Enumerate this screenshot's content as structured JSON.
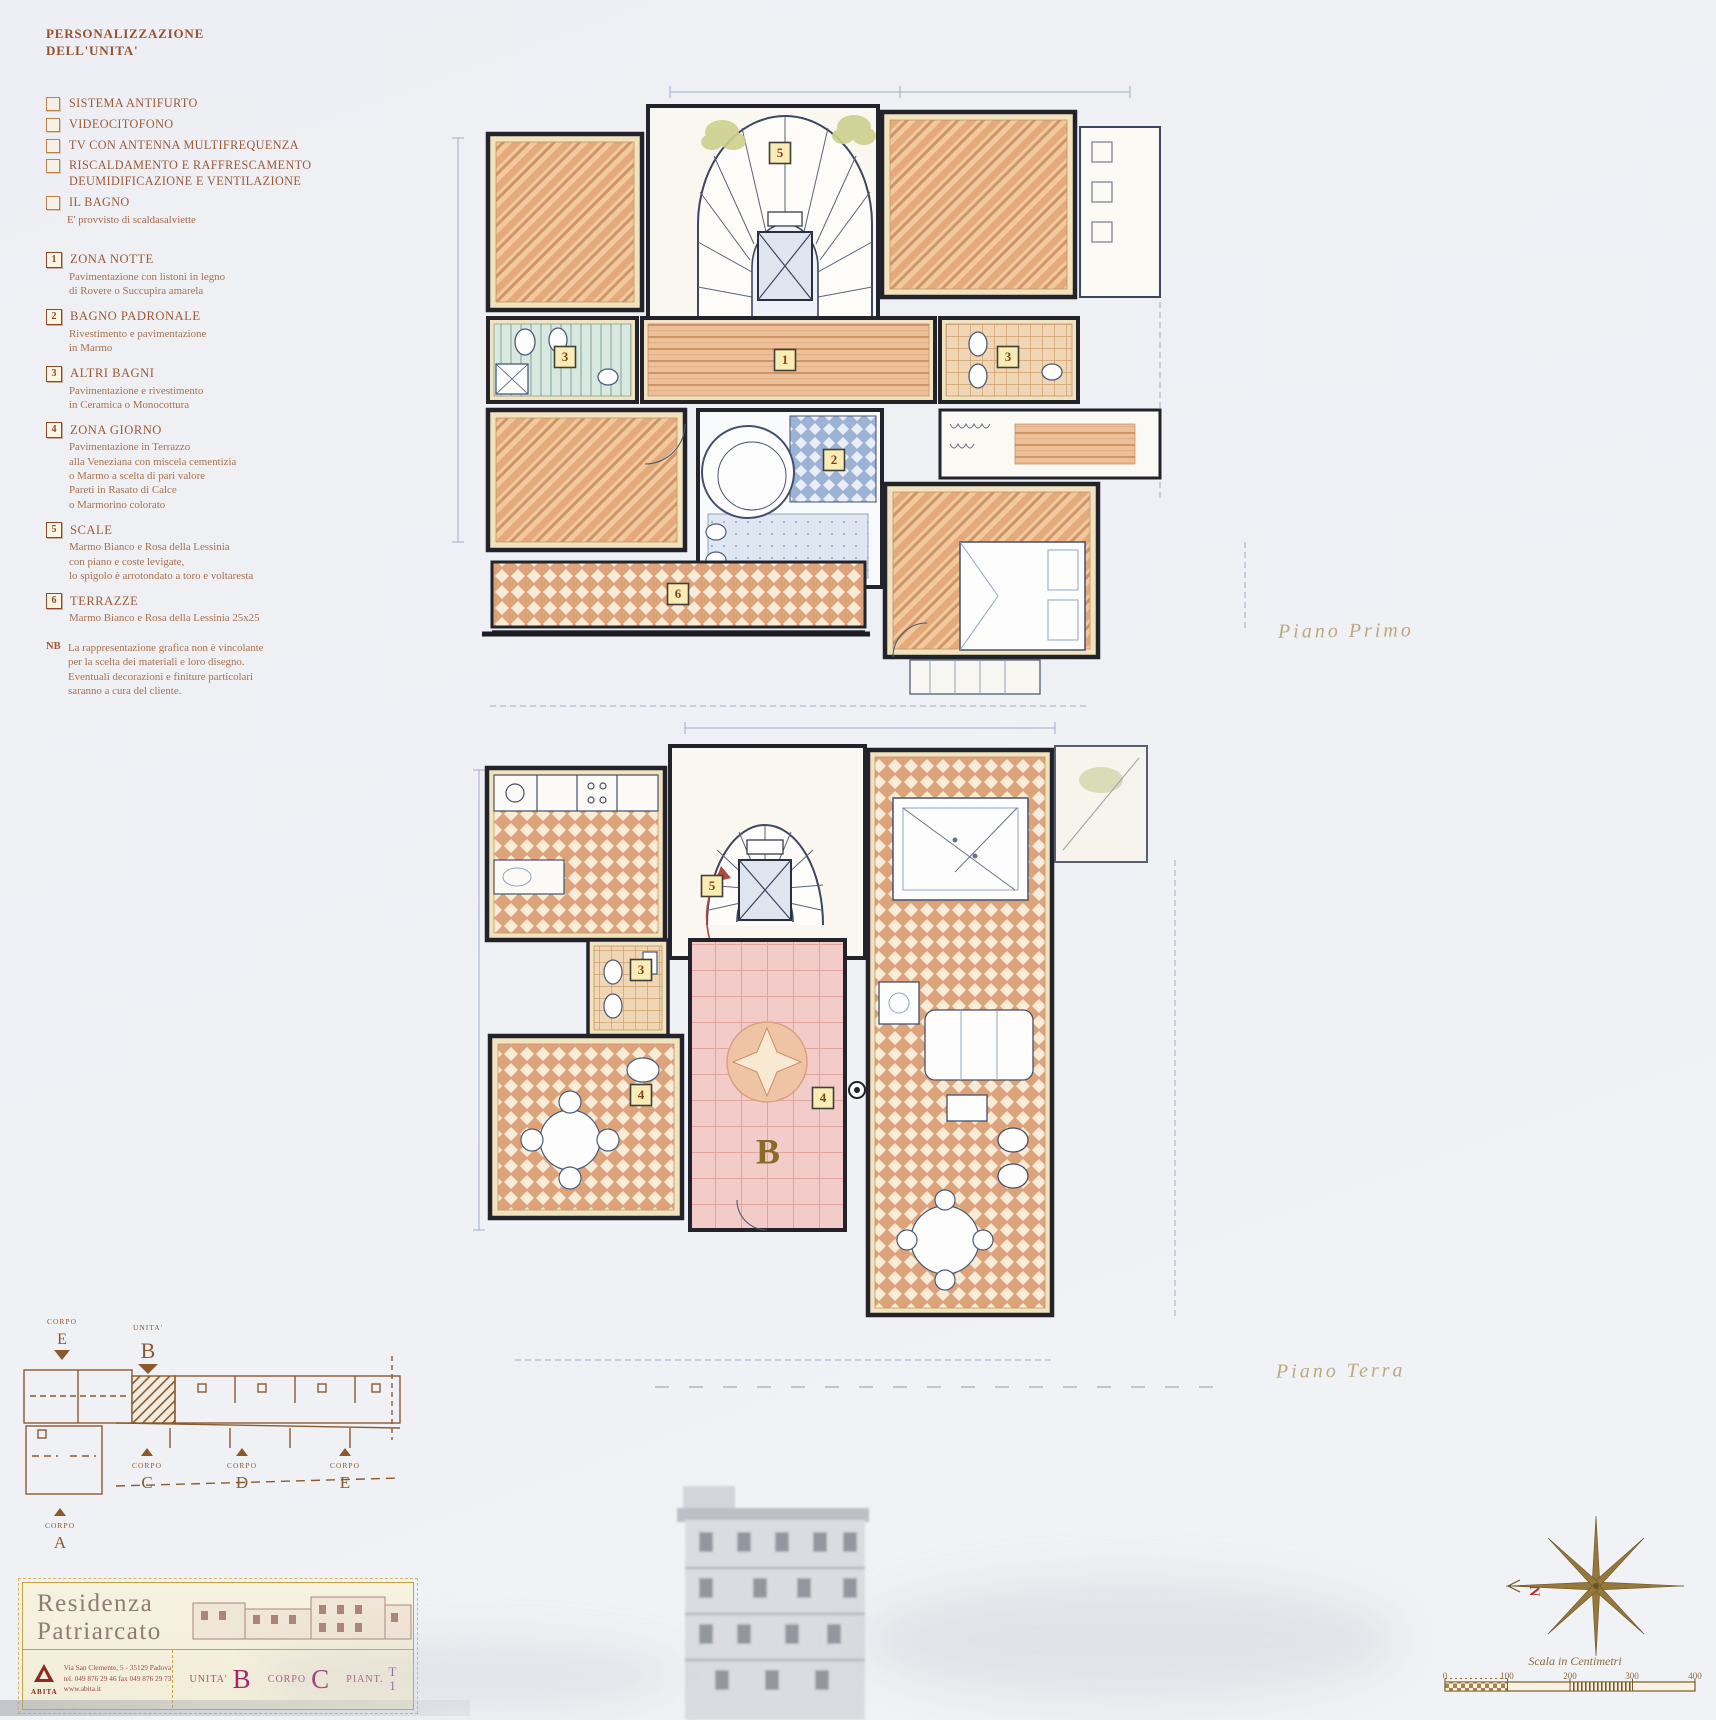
{
  "colors": {
    "paper": "#eff1f5",
    "ink": "#23232c",
    "sepia": "#9c5a36",
    "wood": "#edbd92",
    "tile_terracotta": "#dda47c",
    "terrazzo_pink": "#f3cbc8",
    "bath_blue": "#9db3d6",
    "bath_teal": "#d9e8e1",
    "badge_bg": "#f9ecb4",
    "gold": "#c9a23f",
    "magenta": "#a3266b",
    "site_ink": "#8a5a2e",
    "north_red": "#b23530"
  },
  "legend": {
    "title": "PERSONALIZZAZIONE\nDELL'UNITA'",
    "options": [
      {
        "text": "SISTEMA ANTIFURTO"
      },
      {
        "text": "VIDEOCITOFONO"
      },
      {
        "text": "TV CON ANTENNA MULTIFREQUENZA"
      },
      {
        "text": "RISCALDAMENTO E RAFFRESCAMENTO\nDEUMIDIFICAZIONE E VENTILAZIONE"
      },
      {
        "text": "IL BAGNO",
        "note": "E' provvisto di scaldasalviette"
      }
    ],
    "materials": [
      {
        "num": "1",
        "title": "ZONA NOTTE",
        "desc": "Pavimentazione con listoni in legno\ndi Rovere o Succupira amarela"
      },
      {
        "num": "2",
        "title": "BAGNO PADRONALE",
        "desc": "Rivestimento e pavimentazione\nin Marmo"
      },
      {
        "num": "3",
        "title": "ALTRI BAGNI",
        "desc": "Pavimentazione e rivestimento\nin Ceramica o Monocottura"
      },
      {
        "num": "4",
        "title": "ZONA GIORNO",
        "desc": "Pavimentazione in Terrazzo\nalla Veneziana con miscela cementizia\no Marmo a scelta di pari valore\nPareti in Rasato di Calce\no Marmorino colorato"
      },
      {
        "num": "5",
        "title": "SCALE",
        "desc": "Marmo Bianco e Rosa della Lessinia\ncon piano e coste levigate,\nlo spigolo è arrotondato a toro e voltaresta"
      },
      {
        "num": "6",
        "title": "TERRAZZE",
        "desc": "Marmo Bianco e Rosa della Lessinia 25x25"
      }
    ],
    "nb_label": "NB",
    "nb_text": "La rappresentazione grafica non è vincolante\nper la scelta dei materiali e loro disegno.\nEventuali decorazioni e finiture particolari\nsaranno a cura del cliente."
  },
  "plans": {
    "first": {
      "label": "Piano Primo",
      "badges": {
        "stairs": "5",
        "zona_notte": "1",
        "bagno_left": "3",
        "bagno_right": "3",
        "bagno_padronale": "2",
        "terrazza": "6"
      }
    },
    "ground": {
      "label": "Piano Terra",
      "badges": {
        "stairs": "5",
        "bagno": "3",
        "zona_giorno_left": "4",
        "zona_giorno_hall": "4"
      },
      "unit_letter": "B"
    }
  },
  "site_plan": {
    "corpo_top": {
      "label": "CORPO",
      "letter": "E"
    },
    "unita": {
      "label": "UNITA'",
      "letter": "B"
    },
    "corpo_c": {
      "label": "CORPO",
      "letter": "C"
    },
    "corpo_d": {
      "label": "CORPO",
      "letter": "D"
    },
    "corpo_e": {
      "label": "CORPO",
      "letter": "E"
    },
    "corpo_a": {
      "label": "CORPO",
      "letter": "A"
    }
  },
  "title_block": {
    "name": "Residenza\nPatriarcato",
    "logo": "ABITA",
    "address": "Via San Clemente, 5 - 35129 Padova\ntel. 049 876 29 46  fax 049 876 29 73\nwww.abita.it",
    "unita_label": "UNITA'",
    "unita_value": "B",
    "corpo_label": "CORPO",
    "corpo_value": "C",
    "piano_label": "PIANT.",
    "piano_top": "T",
    "piano_bottom": "1"
  },
  "compass": {
    "north": "N"
  },
  "scale_bar": {
    "title": "Scala in Centimetri",
    "ticks": [
      "0",
      "100",
      "200",
      "300",
      "400"
    ]
  }
}
